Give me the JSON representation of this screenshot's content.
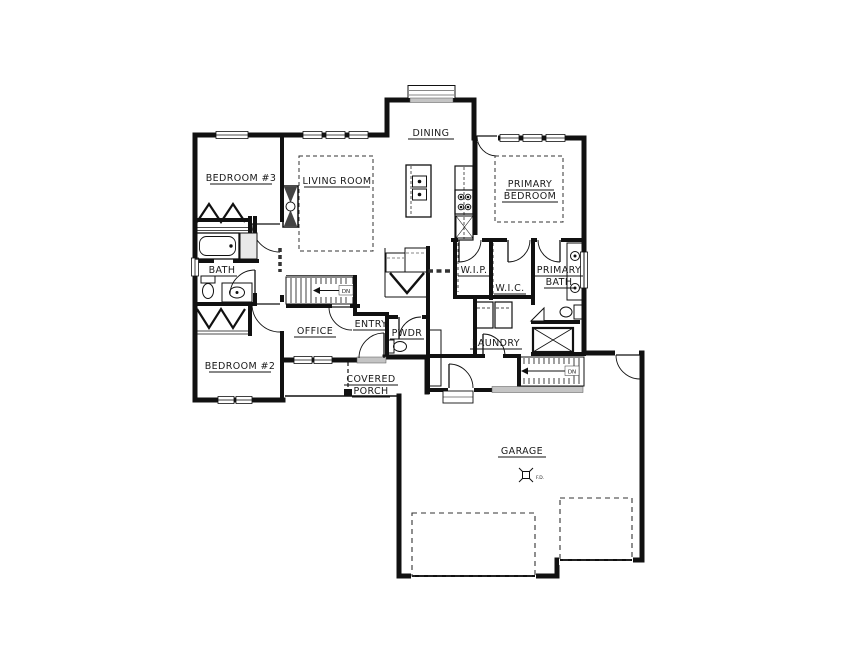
{
  "rooms": {
    "dining": "DINING",
    "bedroom3": "BEDROOM #3",
    "living_room": "LIVING ROOM",
    "primary_bedroom_line1": "PRIMARY",
    "primary_bedroom_line2": "BEDROOM",
    "bath": "BATH",
    "wip": "W.I.P.",
    "wic": "W.I.C.",
    "primary_bath_line1": "PRIMARY",
    "primary_bath_line2": "BATH",
    "office": "OFFICE",
    "entry": "ENTRY",
    "powder": "PWDR",
    "laundry": "LAUNDRY",
    "bedroom2": "BEDROOM #2",
    "covered_porch_line1": "COVERED",
    "covered_porch_line2": "PORCH",
    "garage": "GARAGE"
  },
  "annotations": {
    "stairs_main_direction": "DN",
    "stairs_basement_direction": "DN",
    "floor_drain": "F.D."
  },
  "colors": {
    "wall": "#111111",
    "background": "#ffffff",
    "sill_gray": "#c4c4c4"
  }
}
